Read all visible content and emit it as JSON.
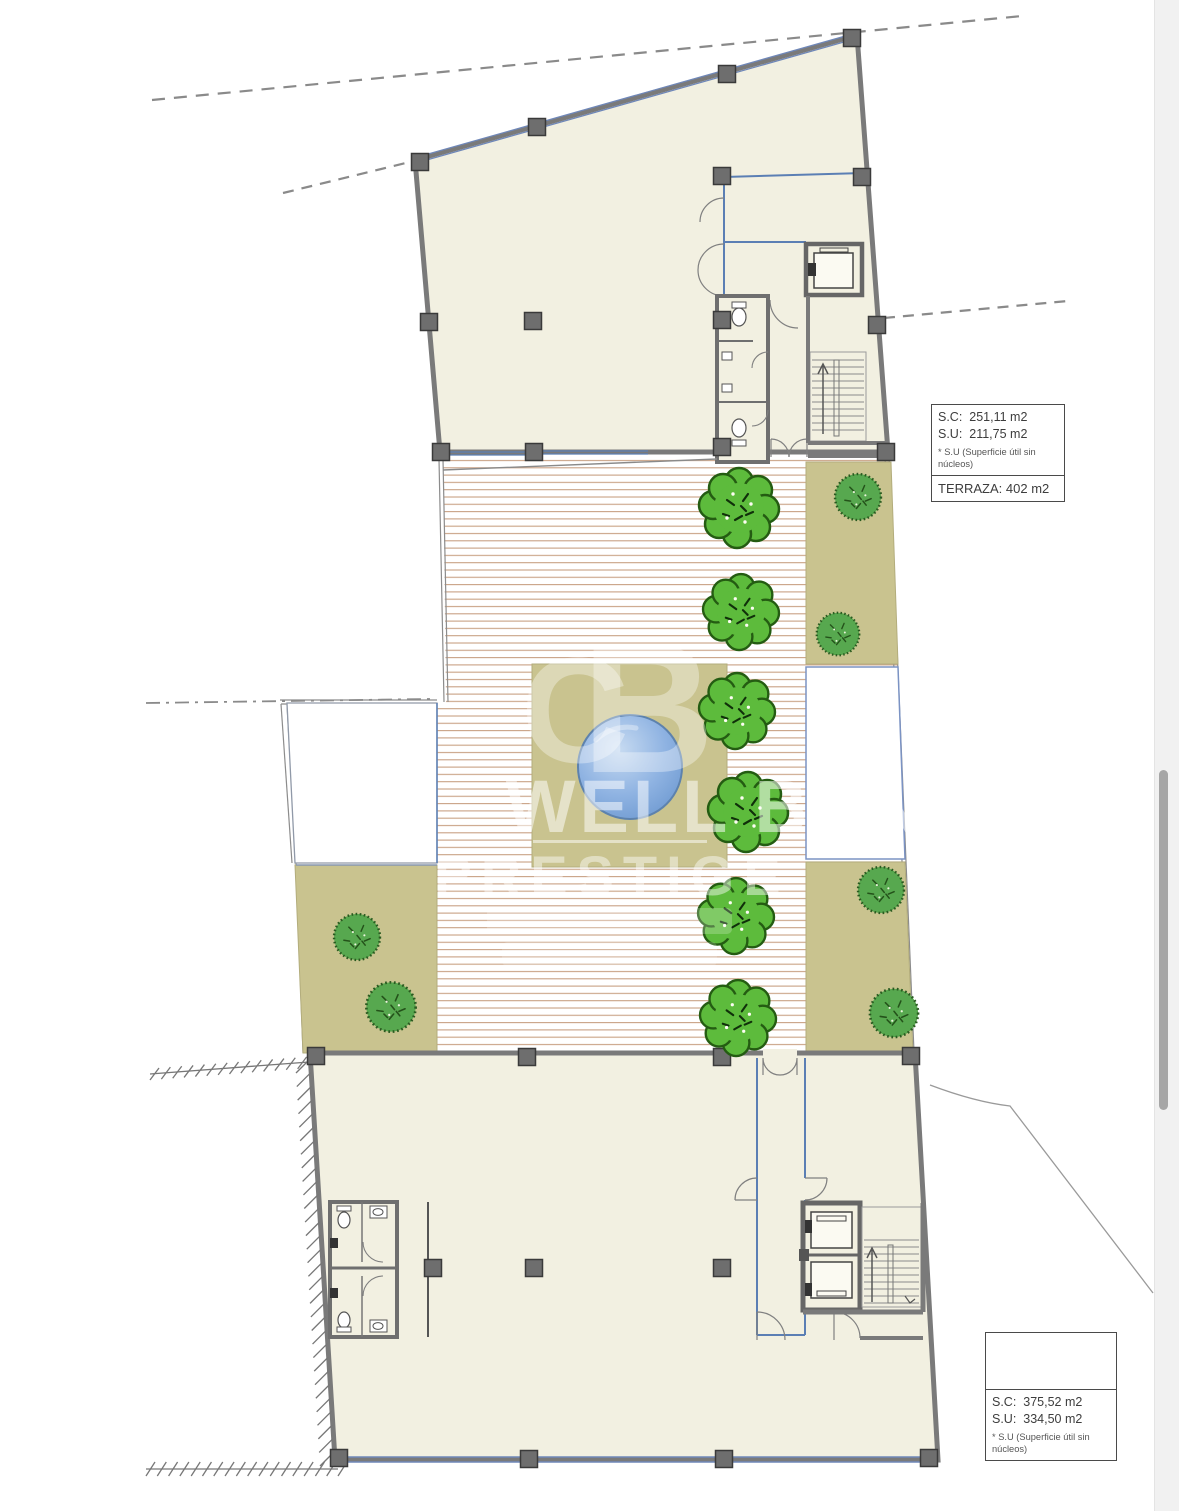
{
  "document": {
    "kind": "terrace-floor-plan"
  },
  "info_box_upper": {
    "line1": "S.C:  251,11 m2",
    "line2": "S.U:  211,75 m2",
    "note": "* S.U (Superficie útil sin núcleos)",
    "terrace": "TERRAZA: 402 m2"
  },
  "info_box_lower": {
    "line1": "S.C:  375,52 m2",
    "line2": "S.U:  334,50 m2",
    "note": "* S.U (Superficie útil sin núcleos)"
  },
  "watermark": {
    "monogram": "CB",
    "line1": "WELL BANK",
    "line2": "PRESTIGE"
  },
  "colors": {
    "wall": "#7a7a7a",
    "wall_dark": "#3a3a3a",
    "column": "#6e6e6e",
    "glazing_blue": "#6f87b8",
    "interior_blue": "#5b7fb4",
    "floor": "#f2f0e1",
    "deck_line": "#c9a184",
    "garden": "#c9c38f",
    "garden_edge": "#b3ad7c",
    "tree": "#5dbb3c",
    "tree_outline": "#245c12",
    "bush": "#57a84f",
    "bush_outline": "#2a5a20",
    "pool": "#7fa9dd",
    "pool_edge": "#5d82ad",
    "boundary": "#8c8c8c",
    "scrollbar_thumb": "#a6a6a6"
  },
  "plan": {
    "trees": [
      {
        "x": 739,
        "y": 508,
        "s": 1.0
      },
      {
        "x": 741,
        "y": 612,
        "s": 0.95
      },
      {
        "x": 737,
        "y": 711,
        "s": 0.95
      },
      {
        "x": 748,
        "y": 812,
        "s": 1.0
      },
      {
        "x": 736,
        "y": 916,
        "s": 0.95
      },
      {
        "x": 738,
        "y": 1018,
        "s": 0.95
      }
    ],
    "bushes": [
      {
        "x": 858,
        "y": 497,
        "s": 0.82
      },
      {
        "x": 838,
        "y": 634,
        "s": 0.76
      },
      {
        "x": 357,
        "y": 937,
        "s": 0.82
      },
      {
        "x": 391,
        "y": 1007,
        "s": 0.88
      },
      {
        "x": 881,
        "y": 890,
        "s": 0.82
      },
      {
        "x": 894,
        "y": 1013,
        "s": 0.86
      }
    ],
    "columns": [
      [
        420,
        162
      ],
      [
        537,
        127
      ],
      [
        727,
        74
      ],
      [
        852,
        38
      ],
      [
        862,
        177
      ],
      [
        877,
        325
      ],
      [
        429,
        322
      ],
      [
        722,
        176
      ],
      [
        441,
        452
      ],
      [
        534,
        452
      ],
      [
        886,
        452
      ],
      [
        533,
        321
      ],
      [
        722,
        320
      ],
      [
        722,
        447
      ],
      [
        316,
        1056
      ],
      [
        527,
        1057
      ],
      [
        722,
        1057
      ],
      [
        911,
        1056
      ],
      [
        433,
        1268
      ],
      [
        534,
        1268
      ],
      [
        722,
        1268
      ],
      [
        339,
        1458
      ],
      [
        529,
        1459
      ],
      [
        724,
        1459
      ],
      [
        929,
        1458
      ]
    ],
    "pool": {
      "x": 630,
      "y": 767,
      "r": 52
    }
  }
}
